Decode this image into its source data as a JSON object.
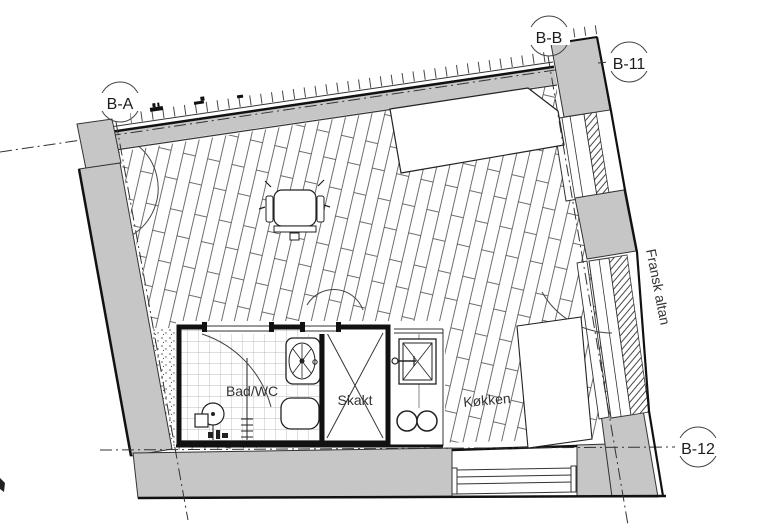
{
  "labels": {
    "bathroom": "Bad/WC",
    "shaft": "Skakt",
    "kitchen": "Køkken",
    "balcony": "Fransk altan",
    "section_top": "B-B",
    "section_right_top": "B-11",
    "section_left_top": "B-A",
    "section_right_bottom": "B-12"
  },
  "colors": {
    "wall_fill": "#c6c6c6",
    "line": "#1d1d1d",
    "background": "#ffffff",
    "tile_line": "#a8a8a8",
    "plank_line": "#4a4a4a"
  }
}
